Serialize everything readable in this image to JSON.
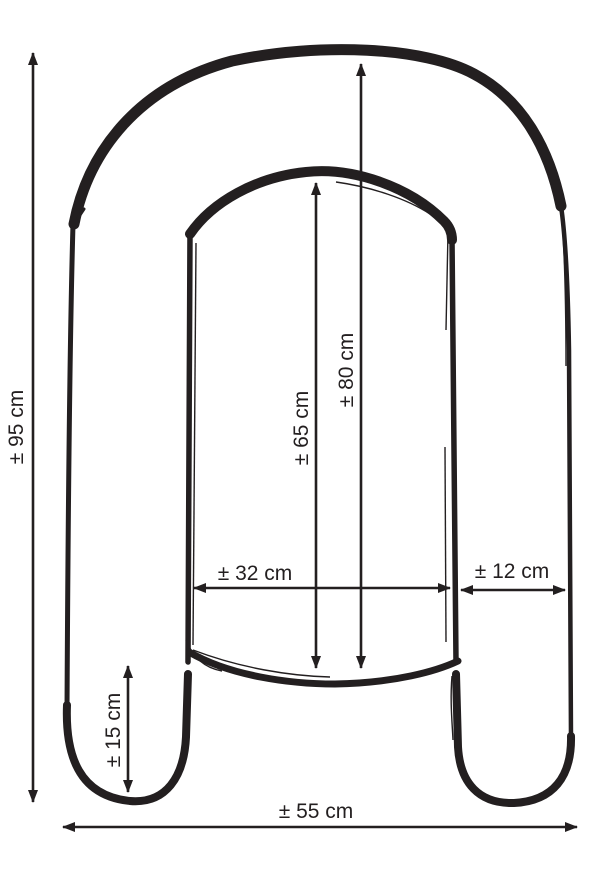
{
  "diagram": {
    "subject": "u-shaped-pillow-dimension-drawing",
    "unit": "cm",
    "line_color": "#231f20",
    "background_color": "#ffffff",
    "measurements": {
      "overall_height": {
        "label": "± 95 cm",
        "value": 95,
        "orientation": "vertical"
      },
      "outer_top_to_opening": {
        "label": "± 80 cm",
        "value": 80,
        "orientation": "vertical"
      },
      "inner_height": {
        "label": "± 65 cm",
        "value": 65,
        "orientation": "vertical"
      },
      "inner_width": {
        "label": "± 32 cm",
        "value": 32,
        "orientation": "horizontal"
      },
      "tube_width": {
        "label": "± 12 cm",
        "value": 12,
        "orientation": "horizontal"
      },
      "leg_tip_height": {
        "label": "± 15 cm",
        "value": 15,
        "orientation": "vertical"
      },
      "overall_width": {
        "label": "± 55 cm",
        "value": 55,
        "orientation": "horizontal"
      }
    }
  }
}
